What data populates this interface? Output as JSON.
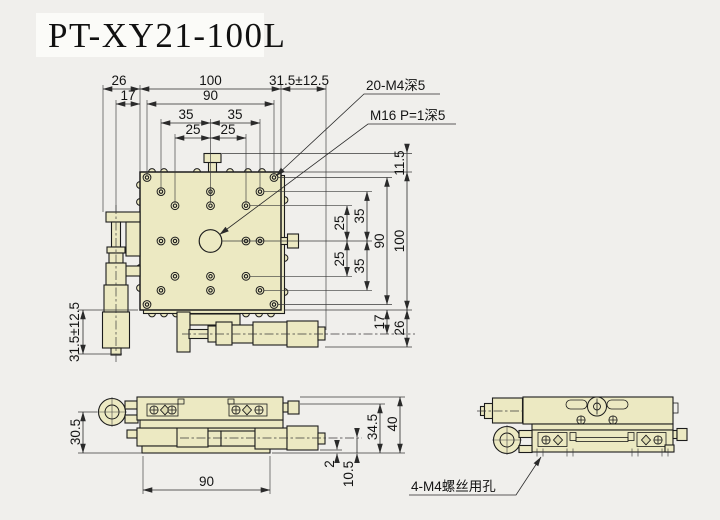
{
  "title": "PT-XY21-100L",
  "colors": {
    "background": "#f0efec",
    "title_band": "#fbfbf8",
    "part_fill": "#ece9c2",
    "line": "#1c1c1c"
  },
  "plan": {
    "hole_note": "20-M4深5",
    "center_note": "M16 P=1深5",
    "top": {
      "overhang": "26",
      "cl_offset": "17",
      "size": "100",
      "pattern": "90",
      "p35_l": "35",
      "p35_r": "35",
      "p25_l": "25",
      "p25_r": "25",
      "travel": "31.5±12.5"
    },
    "right": {
      "knob": "11.5",
      "size": "100",
      "pattern": "90",
      "p35_u": "35",
      "p25_u": "25",
      "p25_d": "25",
      "p35_d": "35",
      "cl_offset": "17",
      "overhang": "26"
    },
    "left": {
      "travel": "31.5±12.5"
    }
  },
  "front": {
    "knob_height": "30.5",
    "base_width": "90",
    "gap": "2",
    "mic_height": "10.5",
    "table_height": "34.5",
    "total_height": "40"
  },
  "side": {
    "mount_note": "4-M4螺丝用孔"
  }
}
